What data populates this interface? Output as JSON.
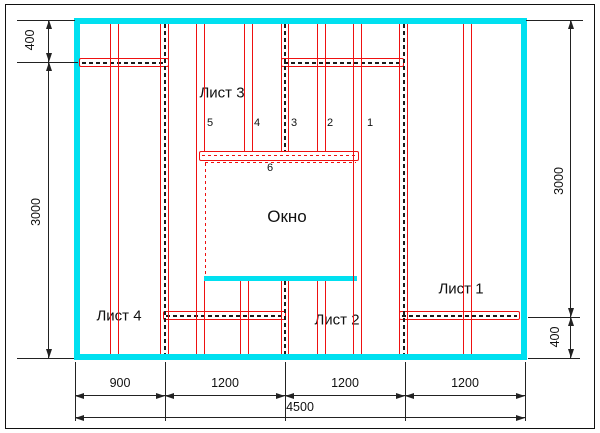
{
  "labels": {
    "sheet1": "Лист 1",
    "sheet2": "Лист 2",
    "sheet3": "Лист 3",
    "sheet4": "Лист 4",
    "window": "Окно"
  },
  "stud_numbers": {
    "n1": "1",
    "n2": "2",
    "n3": "3",
    "n4": "4",
    "n5": "5",
    "n6": "6"
  },
  "dimensions": {
    "left_top": "400",
    "left_height": "3000",
    "right_height": "3000",
    "right_bottom": "400",
    "bottom_segments": [
      "900",
      "1200",
      "1200",
      "1200"
    ],
    "bottom_total": "4500"
  },
  "colors": {
    "wall_outline": "#00e0f0",
    "framing": "#ee1111",
    "dimension": "#222222",
    "centerline": "#1a1a1a",
    "background": "#ffffff"
  }
}
